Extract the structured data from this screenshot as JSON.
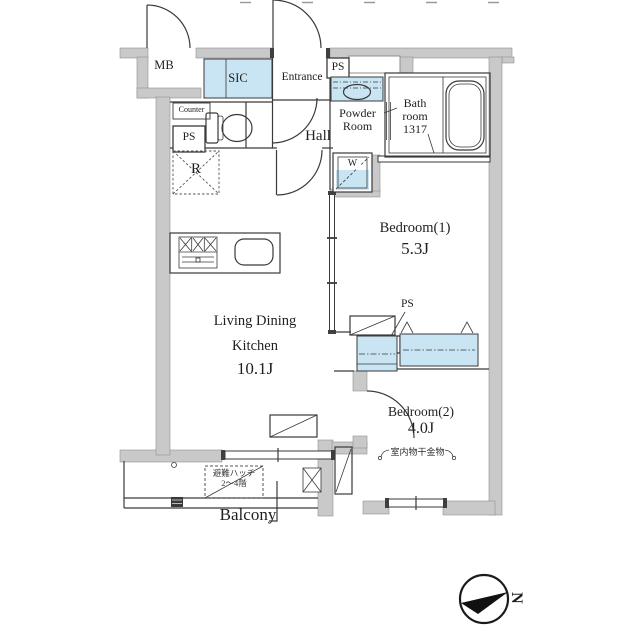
{
  "floor_plan": {
    "rooms": {
      "mb": {
        "label": "MB"
      },
      "sic": {
        "label": "SIC"
      },
      "entrance": {
        "label": "Entrance"
      },
      "hall": {
        "label": "Hall"
      },
      "powder_room": {
        "label_line1": "Powder",
        "label_line2": "Room"
      },
      "bathroom": {
        "label_line1": "Bath",
        "label_line2": "room",
        "size_code": "1317"
      },
      "ldk": {
        "label_line1": "Living Dining",
        "label_line2": "Kitchen",
        "area": "10.1J"
      },
      "bedroom1": {
        "label": "Bedroom(1)",
        "area": "5.3J"
      },
      "bedroom2": {
        "label": "Bedroom(2)",
        "area": "4.0J",
        "laundry_note": "室内物干金物"
      },
      "balcony": {
        "label": "Balcony",
        "hatch_line1": "避難ハッチ",
        "hatch_line2": "2〜4階"
      }
    },
    "fixtures": {
      "ps_top": {
        "label": "PS"
      },
      "ps_utility": {
        "label": "PS"
      },
      "ps_closet": {
        "label": "PS"
      },
      "counter": {
        "label": "Counter"
      },
      "refrigerator": {
        "label": "R"
      },
      "washer": {
        "label": "W"
      }
    },
    "compass": {
      "north_letter": "N"
    },
    "colors": {
      "wall_fill": "#c9c9c9",
      "fixture_fill": "#c9e4f2",
      "line": "#333333"
    }
  }
}
